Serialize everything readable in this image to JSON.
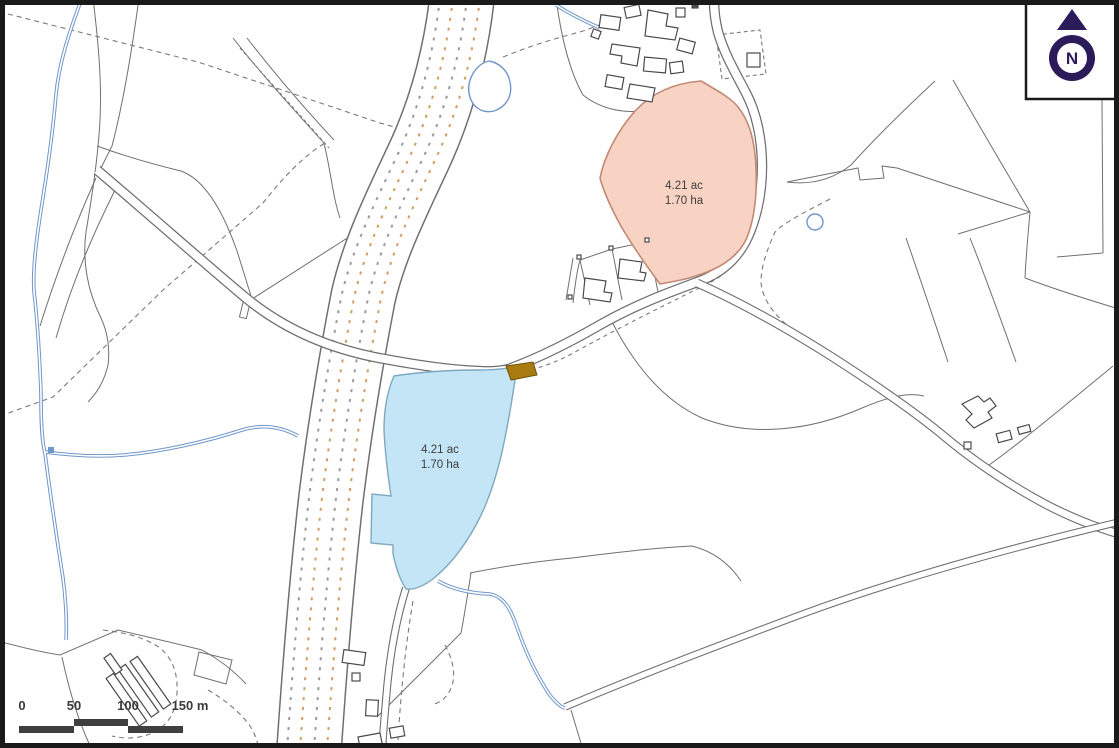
{
  "map": {
    "title": "site-location-plan",
    "parcels": {
      "pink": {
        "area_ac": "4.21 ac",
        "area_ha": "1.70 ha",
        "fill": "#f8d2c2",
        "stroke": "#c08a76"
      },
      "blue": {
        "area_ac": "4.21 ac",
        "area_ha": "1.70 ha",
        "fill": "#c3e5f6",
        "stroke": "#7fa7c0"
      },
      "brown": {
        "fill": "#a97c12",
        "stroke": "#6f5208"
      }
    },
    "scale_bar": {
      "labels": [
        "0",
        "50",
        "100",
        "150 m"
      ],
      "bar_color": "#3f3f3f"
    },
    "north_arrow": {
      "label": "N",
      "color": "#2b1b5a"
    },
    "colors": {
      "frame": "#1a1a1a",
      "field_line": "#707070",
      "building_line": "#4a4a4a",
      "stream": "#6f96c8",
      "path_dash": "#7a7a7a",
      "corridor_dash_tan": "#cf9e63",
      "corridor_dash_gray": "#9a9a9a"
    }
  }
}
